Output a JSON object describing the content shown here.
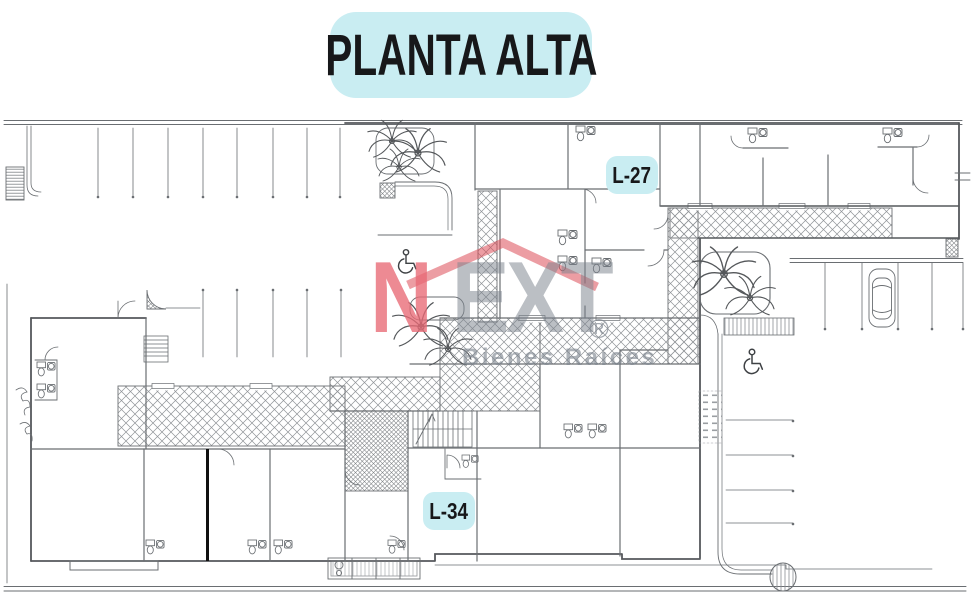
{
  "title": {
    "text": "PLANTA ALTA"
  },
  "badges": {
    "l27": "L-27",
    "l34": "L-34"
  },
  "watermark": {
    "n": "N",
    "ext": "EXT",
    "registered": "®",
    "tagline": "Bienes Raíces"
  },
  "colors": {
    "badge_bg": "#c9edf2",
    "title_bg": "#c9edf2",
    "plan_line": "#63666a",
    "wall_line": "#55585c",
    "roof_red": "#dd4d58",
    "brand_pink": "#e86974",
    "brand_gray": "#7d848e",
    "divider_black": "#101010"
  },
  "plan": {
    "type": "architectural-floor-plan",
    "floor": "upper floor (planta alta)",
    "units_labeled": [
      "L-27",
      "L-34"
    ],
    "features": [
      {
        "name": "parking-row-top-left",
        "kind": "parking-stalls",
        "count": 8
      },
      {
        "name": "parking-row-mid-left",
        "kind": "parking-stalls",
        "count": 5
      },
      {
        "name": "parking-right-top",
        "kind": "parking-stalls",
        "count": 5
      },
      {
        "name": "parking-right-side",
        "kind": "parking-stalls",
        "count": 4
      },
      {
        "name": "car-icon",
        "kind": "vehicle",
        "count": 1
      },
      {
        "name": "wheelchair-icon",
        "kind": "accessible-parking",
        "count": 2
      },
      {
        "name": "palm-tree-icon",
        "kind": "landscape",
        "count": 7
      },
      {
        "name": "stairs",
        "kind": "circulation",
        "count": 2
      },
      {
        "name": "hatched-corridor",
        "kind": "circulation",
        "count": 6
      },
      {
        "name": "bathroom-fixtures",
        "kind": "sanitary",
        "count": 10
      }
    ]
  }
}
